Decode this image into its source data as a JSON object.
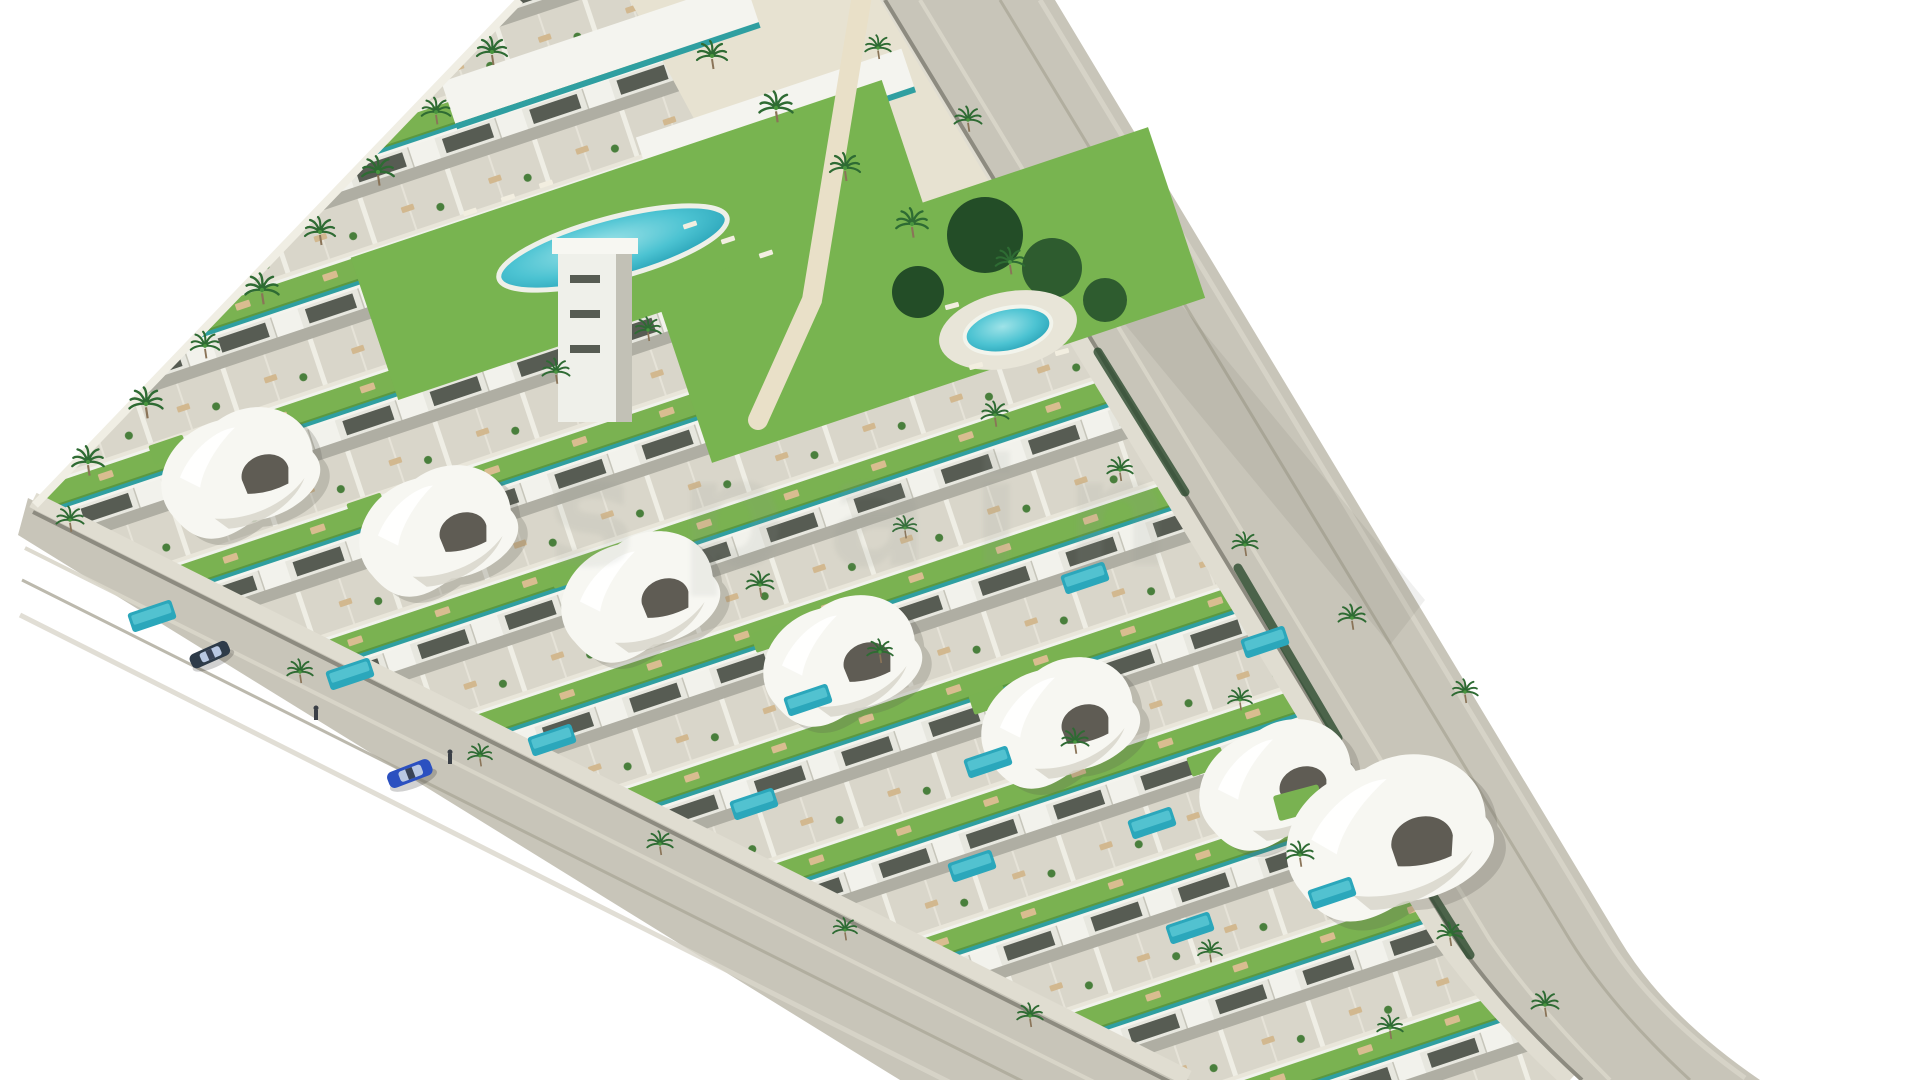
{
  "scene": {
    "description": "Aerial 3D architectural render of a triangular coastal residential development: rows of white townhouses with green roof gardens and teal glass balconies, curved white villas with private plunge pools, a large lagoon-style communal pool, a round communal pool, palm trees, perimeter roads, one blue car driving and one dark car parked",
    "watermark": {
      "text": "spain"
    },
    "palette": {
      "bg": "#ffffff",
      "road": "#c8c5b9",
      "sidewalk": "#e0ddd1",
      "curb": "#8d8b80",
      "stripeLight": "#d9d6ca",
      "stripeDark": "#aba898",
      "ground": "#dcd9cd",
      "wall": "#f0eee4",
      "teal": "#2f9fa1",
      "lawn": "#78b450",
      "pool": "#2ba7bb",
      "poolLight": "#5cc9d6",
      "sand": "#e7e2d1",
      "palm": "#2e6b33",
      "hedge": "#2c4a2e",
      "carBlue": "#2b50c0",
      "carDark": "#2e3b49",
      "walkway": "#e9e0c8",
      "watermarkColor": "#8f968f"
    },
    "inventory": {
      "curved_villas": 7,
      "plunge_pools": 12,
      "communal_pools": 2,
      "palm_trees": 37,
      "cars": 2,
      "pedestrians": 2
    }
  }
}
